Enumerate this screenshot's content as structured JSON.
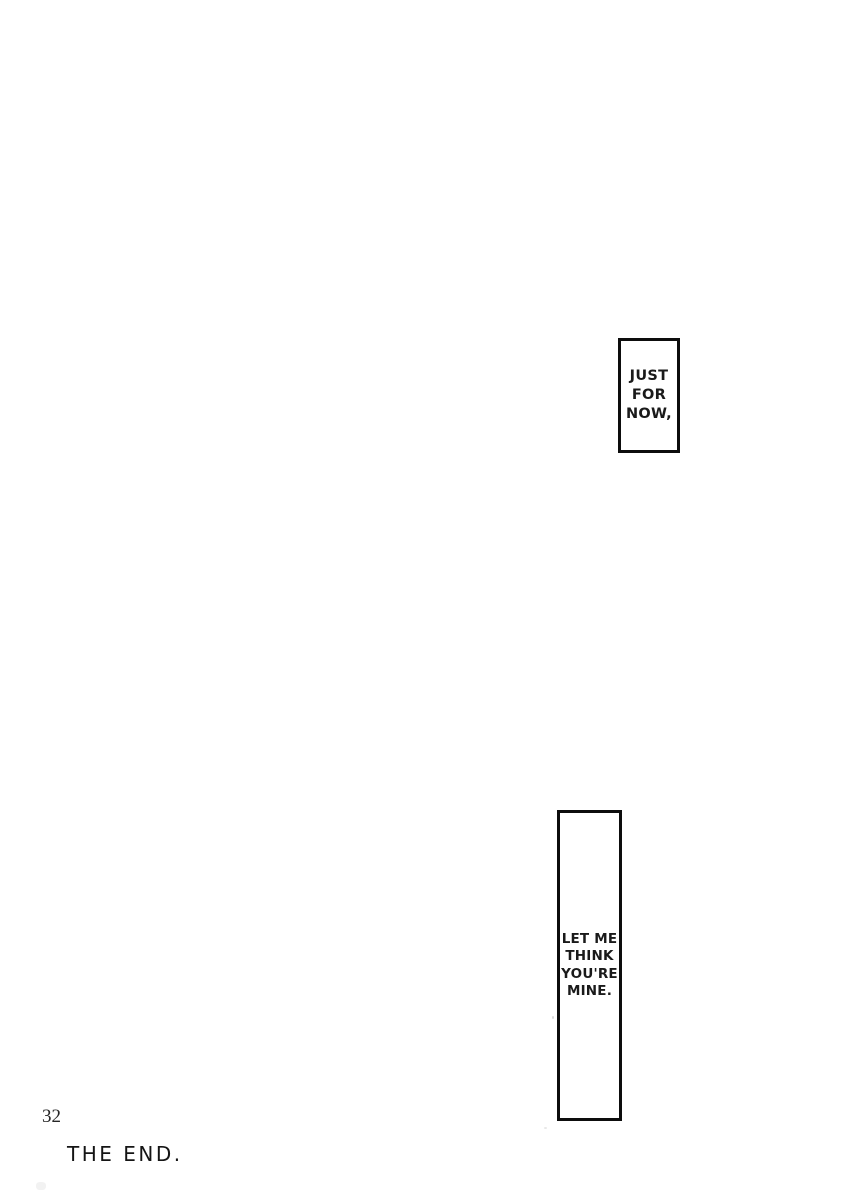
{
  "page": {
    "background": "#ffffff",
    "ink_color": "#1a1a1a",
    "panel_border_color": "#0d0d0d"
  },
  "captions": [
    {
      "name": "just-for-now",
      "lines": [
        "JUST",
        "FOR",
        "NOW,"
      ]
    },
    {
      "name": "let-me-think",
      "lines": [
        "LET ME",
        "THINK",
        "YOU'RE",
        "MINE."
      ]
    }
  ],
  "footer": {
    "page_number": "32",
    "end_label": "THE END."
  }
}
